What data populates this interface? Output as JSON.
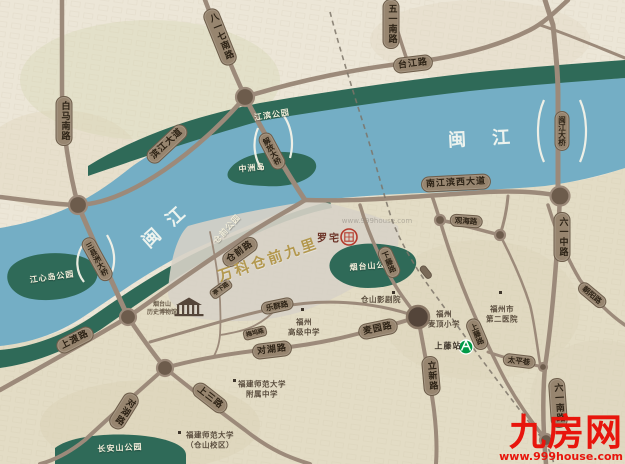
{
  "colors": {
    "river": "#74aec5",
    "park": "#2f6a58",
    "road": "#9c8a7a",
    "gold": "#b3984e",
    "logo_red": "#e8150c"
  },
  "river": {
    "name": "闽江"
  },
  "parks": {
    "jiangbin": "江滨公园",
    "zhongzhoudao": "中洲岛",
    "cangqian": "仓前公园",
    "jiangxindao": "江心岛公园",
    "yantaishan": "烟台山公园",
    "changanshan": "长安山公园"
  },
  "roads": {
    "baima": "白马南路",
    "bayiqi": "八一七南路",
    "binjiang": "滨江大道",
    "taijiang": "台江路",
    "wuyi": "五一南路",
    "liuyizhong": "六一中路",
    "liuyinan": "六一南路",
    "nanjiangbin": "南江滨西大道",
    "cangqianlu": "仓前路",
    "shangdu": "上渡路",
    "duihu_e": "对湖路",
    "duihu_sw": "对湖路",
    "shangsan": "上三路",
    "maiyuan": "麦园路",
    "lixin": "立新路",
    "xiateng": "下藤路",
    "guanhai": "观海路",
    "taiping": "太平巷",
    "chaoyang": "朝阳路",
    "lequn": "乐群路",
    "shangtenglu": "上藤路",
    "tingxia": "亭下路",
    "meiwu": "梅坞路"
  },
  "bridges": {
    "sanxianzhou": "三县洲大桥",
    "jiefang": "解放大桥",
    "minjiang": "闽江大桥"
  },
  "property": {
    "name": "万科仓前九里",
    "landmark_line1": "烟台山",
    "landmark_line2": "历史博物馆"
  },
  "pois": {
    "luozhai": "罗宅",
    "theater": "仓山影剧院",
    "school_line1": "福州",
    "school_line2": "麦顶小学",
    "hospital_line1": "福州市",
    "hospital_line2": "第二医院",
    "gaozhong_line1": "福州",
    "gaozhong_line2": "高级中学",
    "fushida_line1": "福建师范大学",
    "fushida_line2": "附属中学",
    "fushida_cs_line1": "福建师范大学",
    "fushida_cs_line2": "（仓山校区）"
  },
  "metro": {
    "station": "上藤站"
  },
  "logo": {
    "brand": "九房网",
    "url": "www.999house.com",
    "watermark": "www.999house.com"
  }
}
